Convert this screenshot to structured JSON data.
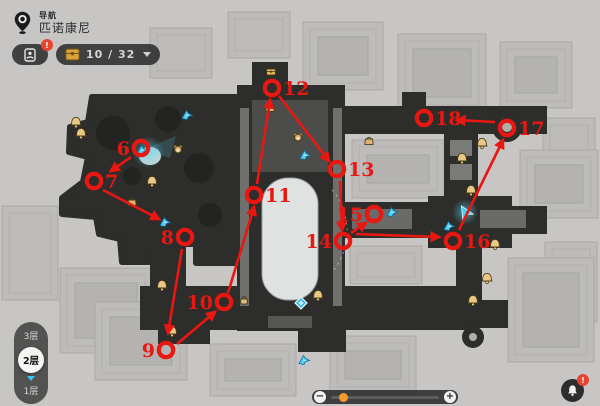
{
  "header": {
    "nav_label": "导航",
    "location_name": "匹诺康尼"
  },
  "toolbar": {
    "gallery_badge": "!",
    "chest_count": "10 / 32"
  },
  "floor_selector": {
    "floors": [
      {
        "label": "3层",
        "selected": false
      },
      {
        "label": "2层",
        "selected": true
      },
      {
        "label": "1层",
        "selected": false
      }
    ]
  },
  "zoom_control": {
    "minus": "−",
    "plus": "+"
  },
  "alert_button": {
    "badge": "!"
  },
  "colors": {
    "route_red": "#e81712",
    "map_dark": "#2d2d2b",
    "accent_cyan": "#3fc8f2",
    "gold": "#dcb272",
    "slider_orange": "#f39b2d",
    "badge_red": "#e8432f"
  },
  "map": {
    "route_markers": [
      {
        "num": "6",
        "cx": 141,
        "cy": 148,
        "side": "left"
      },
      {
        "num": "7",
        "cx": 94,
        "cy": 181,
        "side": "right"
      },
      {
        "num": "8",
        "cx": 185,
        "cy": 237,
        "side": "left"
      },
      {
        "num": "9",
        "cx": 166,
        "cy": 350,
        "side": "left"
      },
      {
        "num": "10",
        "cx": 224,
        "cy": 302,
        "side": "left"
      },
      {
        "num": "11",
        "cx": 254,
        "cy": 195,
        "side": "right"
      },
      {
        "num": "12",
        "cx": 272,
        "cy": 88,
        "side": "right"
      },
      {
        "num": "13",
        "cx": 337,
        "cy": 169,
        "side": "right"
      },
      {
        "num": "14",
        "cx": 343,
        "cy": 241,
        "side": "left"
      },
      {
        "num": "15",
        "cx": 374,
        "cy": 214,
        "side": "left"
      },
      {
        "num": "16",
        "cx": 453,
        "cy": 241,
        "side": "right"
      },
      {
        "num": "17",
        "cx": 507,
        "cy": 128,
        "side": "right"
      },
      {
        "num": "18",
        "cx": 424,
        "cy": 118,
        "side": "right"
      }
    ],
    "route_arrows": [
      {
        "x1": 131,
        "y1": 157,
        "x2": 111,
        "y2": 171
      },
      {
        "x1": 103,
        "y1": 190,
        "x2": 159,
        "y2": 219
      },
      {
        "x1": 182,
        "y1": 249,
        "x2": 168,
        "y2": 333
      },
      {
        "x1": 177,
        "y1": 344,
        "x2": 215,
        "y2": 312
      },
      {
        "x1": 228,
        "y1": 293,
        "x2": 254,
        "y2": 207
      },
      {
        "x1": 257,
        "y1": 184,
        "x2": 270,
        "y2": 100
      },
      {
        "x1": 279,
        "y1": 96,
        "x2": 329,
        "y2": 161
      },
      {
        "x1": 340,
        "y1": 181,
        "x2": 342,
        "y2": 230
      },
      {
        "x1": 351,
        "y1": 233,
        "x2": 366,
        "y2": 223
      },
      {
        "x1": 356,
        "y1": 234,
        "x2": 439,
        "y2": 237
      },
      {
        "x1": 459,
        "y1": 230,
        "x2": 503,
        "y2": 140
      },
      {
        "x1": 495,
        "y1": 122,
        "x2": 457,
        "y2": 120
      }
    ],
    "icons": {
      "bells": [
        [
          76,
          122
        ],
        [
          81,
          133
        ],
        [
          152,
          181
        ],
        [
          162,
          285
        ],
        [
          172,
          331
        ],
        [
          318,
          295
        ],
        [
          482,
          143
        ],
        [
          462,
          158
        ],
        [
          471,
          190
        ],
        [
          495,
          244
        ],
        [
          487,
          278
        ],
        [
          473,
          300
        ]
      ],
      "birds": [
        [
          187,
          115
        ],
        [
          165,
          222
        ],
        [
          305,
          155
        ],
        [
          304,
          360
        ],
        [
          392,
          212
        ],
        [
          449,
          226
        ],
        [
          142,
          150
        ]
      ],
      "bags": [
        [
          270,
          108
        ],
        [
          369,
          141
        ],
        [
          132,
          202
        ]
      ],
      "chests": [
        [
          271,
          72
        ]
      ],
      "monkeys": [
        [
          178,
          149
        ],
        [
          298,
          137
        ]
      ],
      "locks": [
        [
          244,
          300
        ]
      ],
      "teleports": [
        [
          301,
          303
        ]
      ],
      "player": [
        465,
        212
      ]
    }
  }
}
